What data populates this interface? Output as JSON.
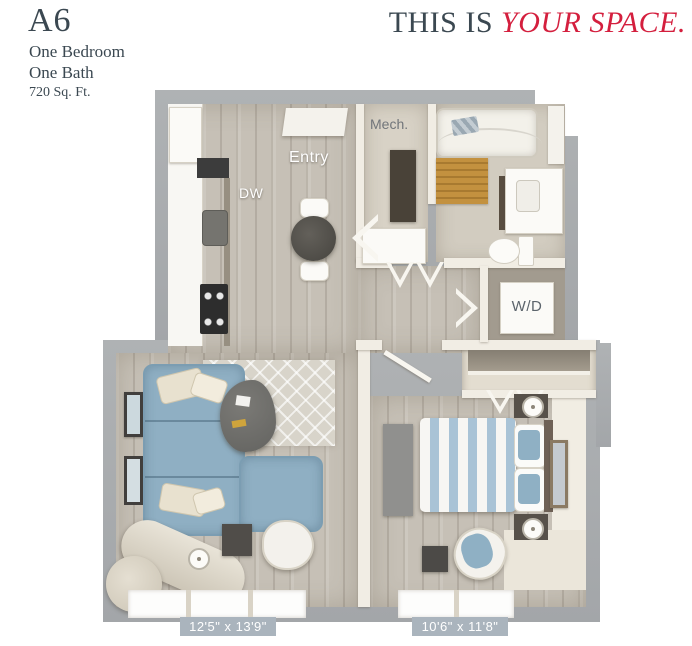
{
  "header": {
    "plan_code": "A6",
    "details": [
      "One Bedroom",
      "One Bath",
      "720 Sq. Ft."
    ],
    "tagline": {
      "prefix": "THIS IS",
      "accent": "YOUR SPACE."
    }
  },
  "floorplan": {
    "labels": {
      "mech": "Mech.",
      "entry": "Entry",
      "dishwasher": "DW",
      "washer_dryer": "W/D"
    },
    "dimensions": {
      "living": "12'5\" x 13'9\"",
      "bedroom": "10'6\" x 11'8\""
    },
    "colors": {
      "heading_text": "#3b4851",
      "accent_red": "#d41f3e",
      "outer_wall": "#a8abae",
      "interior_wall": "#f1ede4",
      "wood_floor": "#c6c0b6",
      "dimension_badge": "#aab4bd",
      "sofa_blue": "#8fafc3",
      "bed_stripe_blue": "#a9c3d6",
      "bath_mat_orange": "#c3913f"
    }
  }
}
